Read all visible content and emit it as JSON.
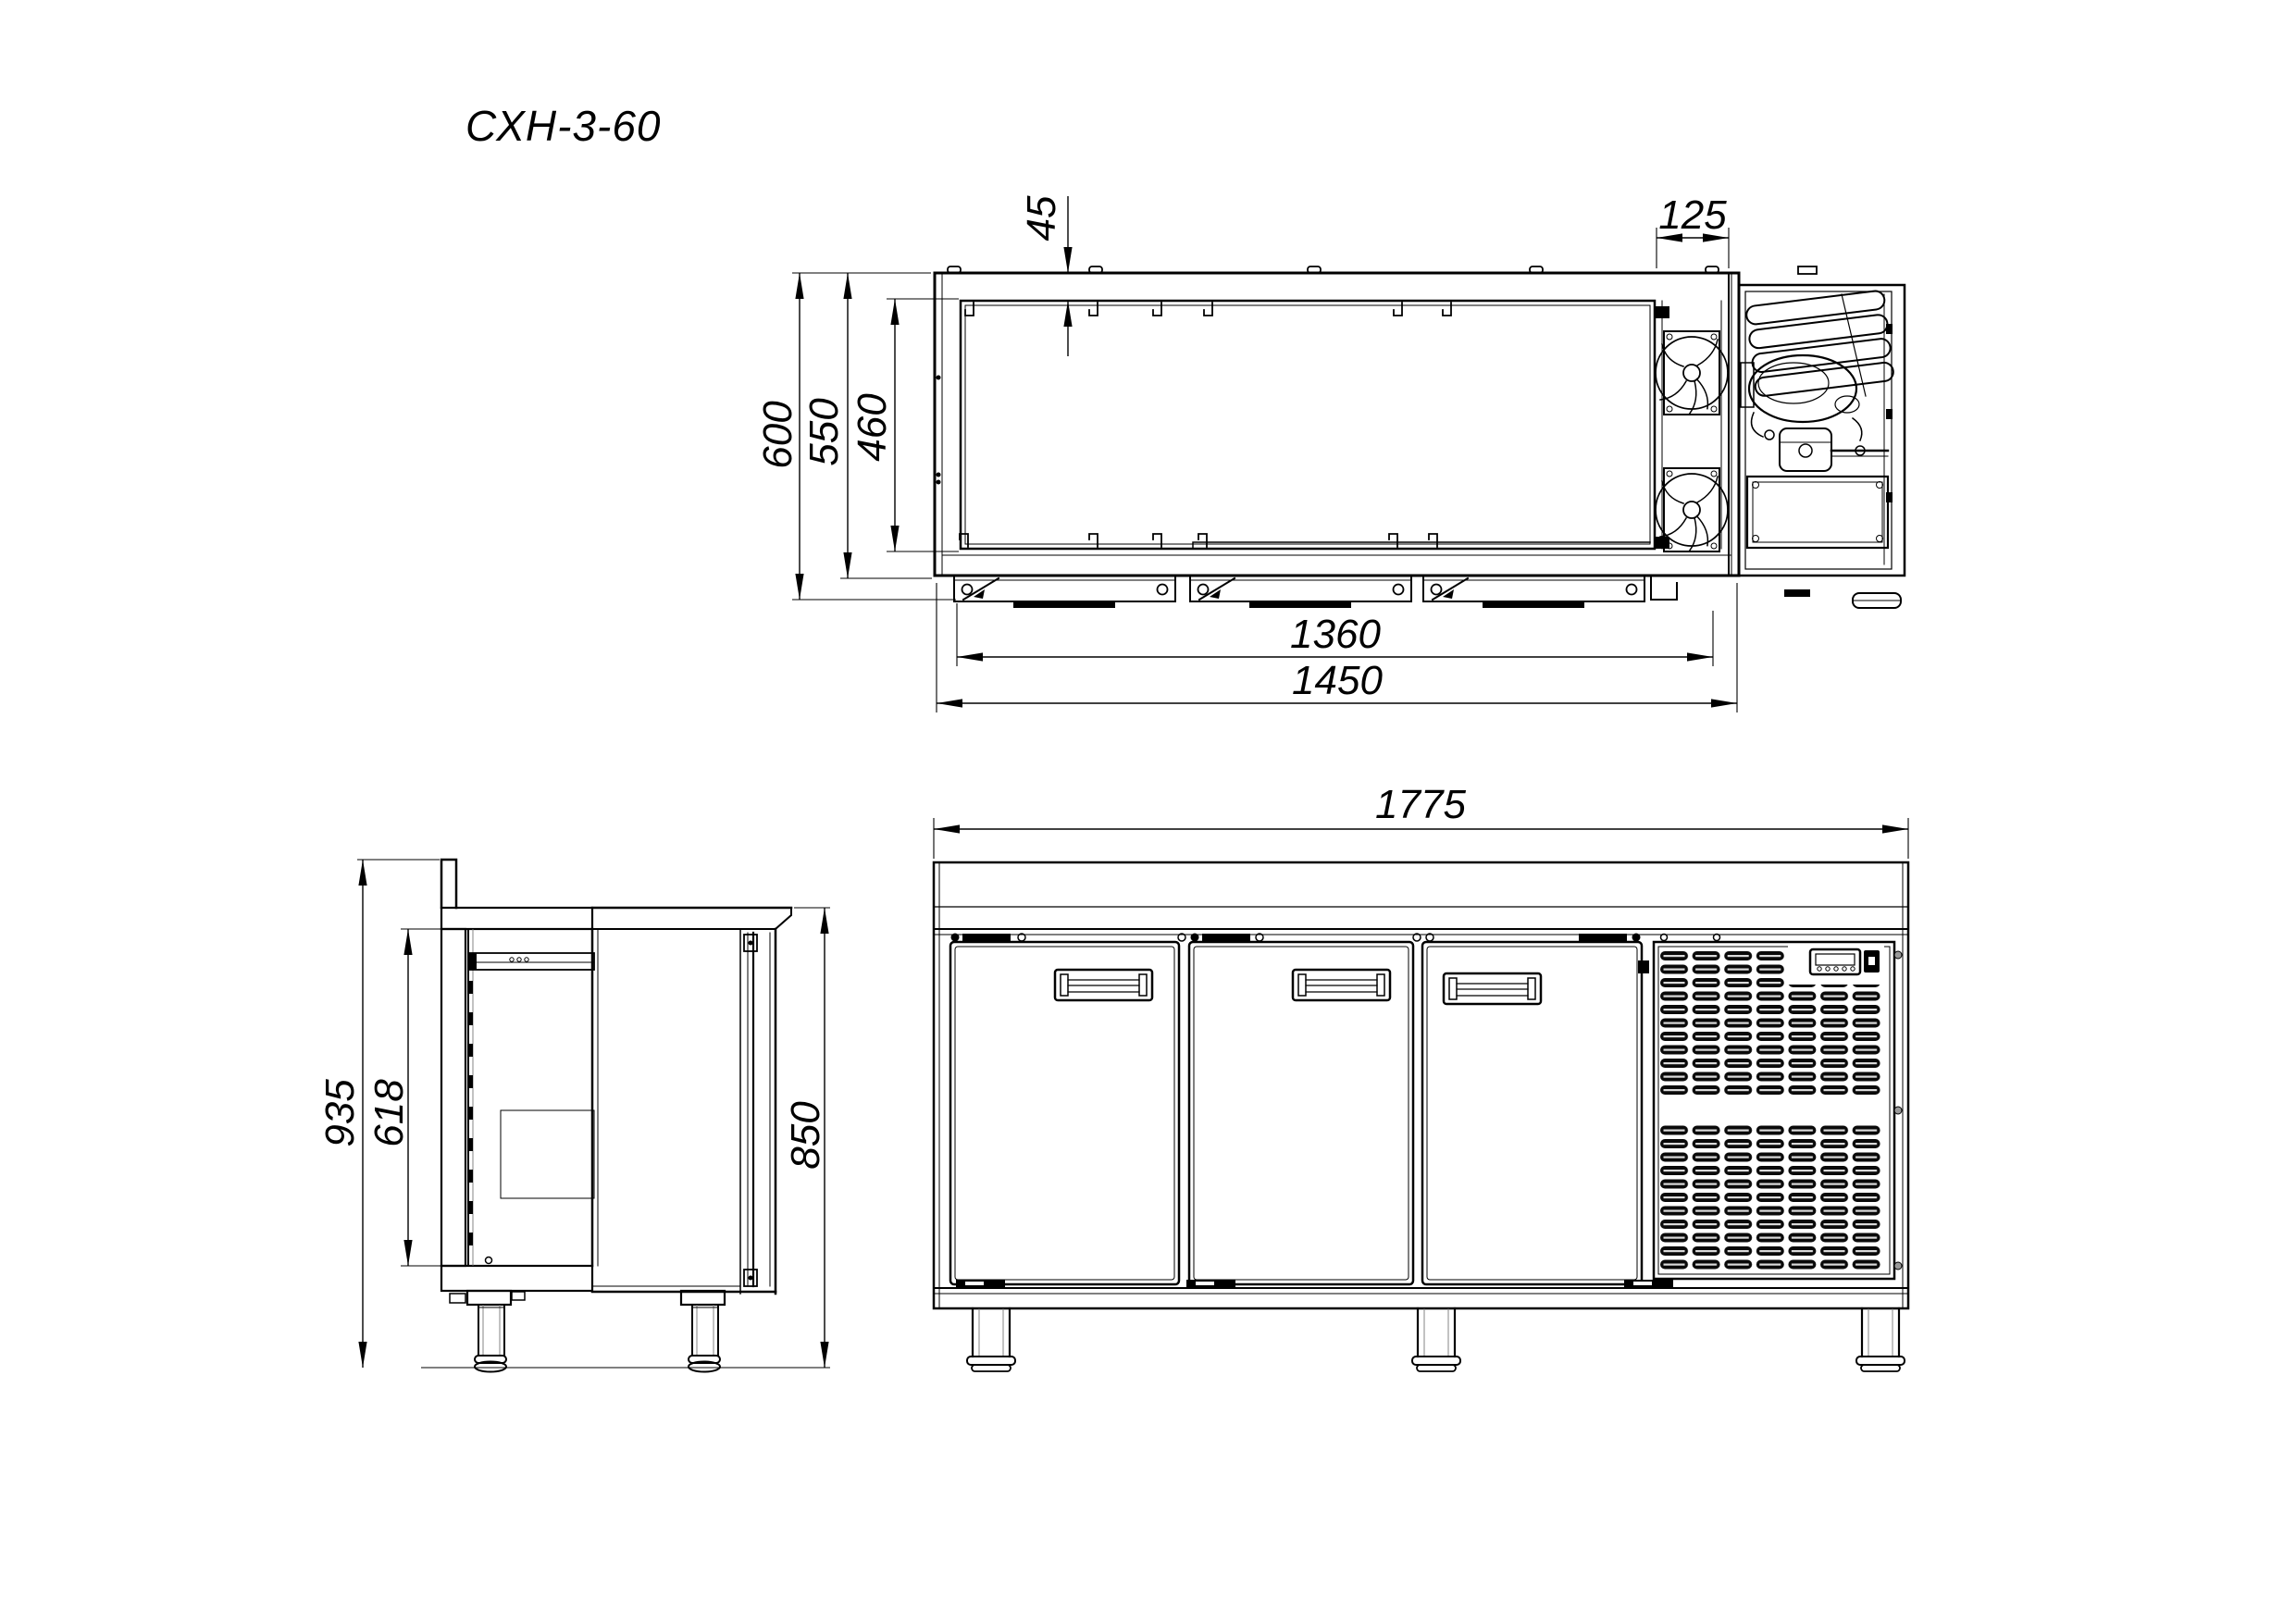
{
  "title": "СХН-3-60",
  "colors": {
    "line": "#000000",
    "background": "#ffffff"
  },
  "views": {
    "plan": {
      "name": "top view",
      "dims": {
        "rear_wall": "45",
        "fan_bay": "125",
        "depth_total": "600",
        "depth_body": "550",
        "depth_inner": "460",
        "width_inner": "1360",
        "width_body": "1450"
      }
    },
    "front": {
      "name": "front view",
      "dims": {
        "width_total": "1775"
      }
    },
    "side": {
      "name": "side view",
      "dims": {
        "height_total": "935",
        "height_inner": "618",
        "height_worktop": "850"
      }
    }
  }
}
